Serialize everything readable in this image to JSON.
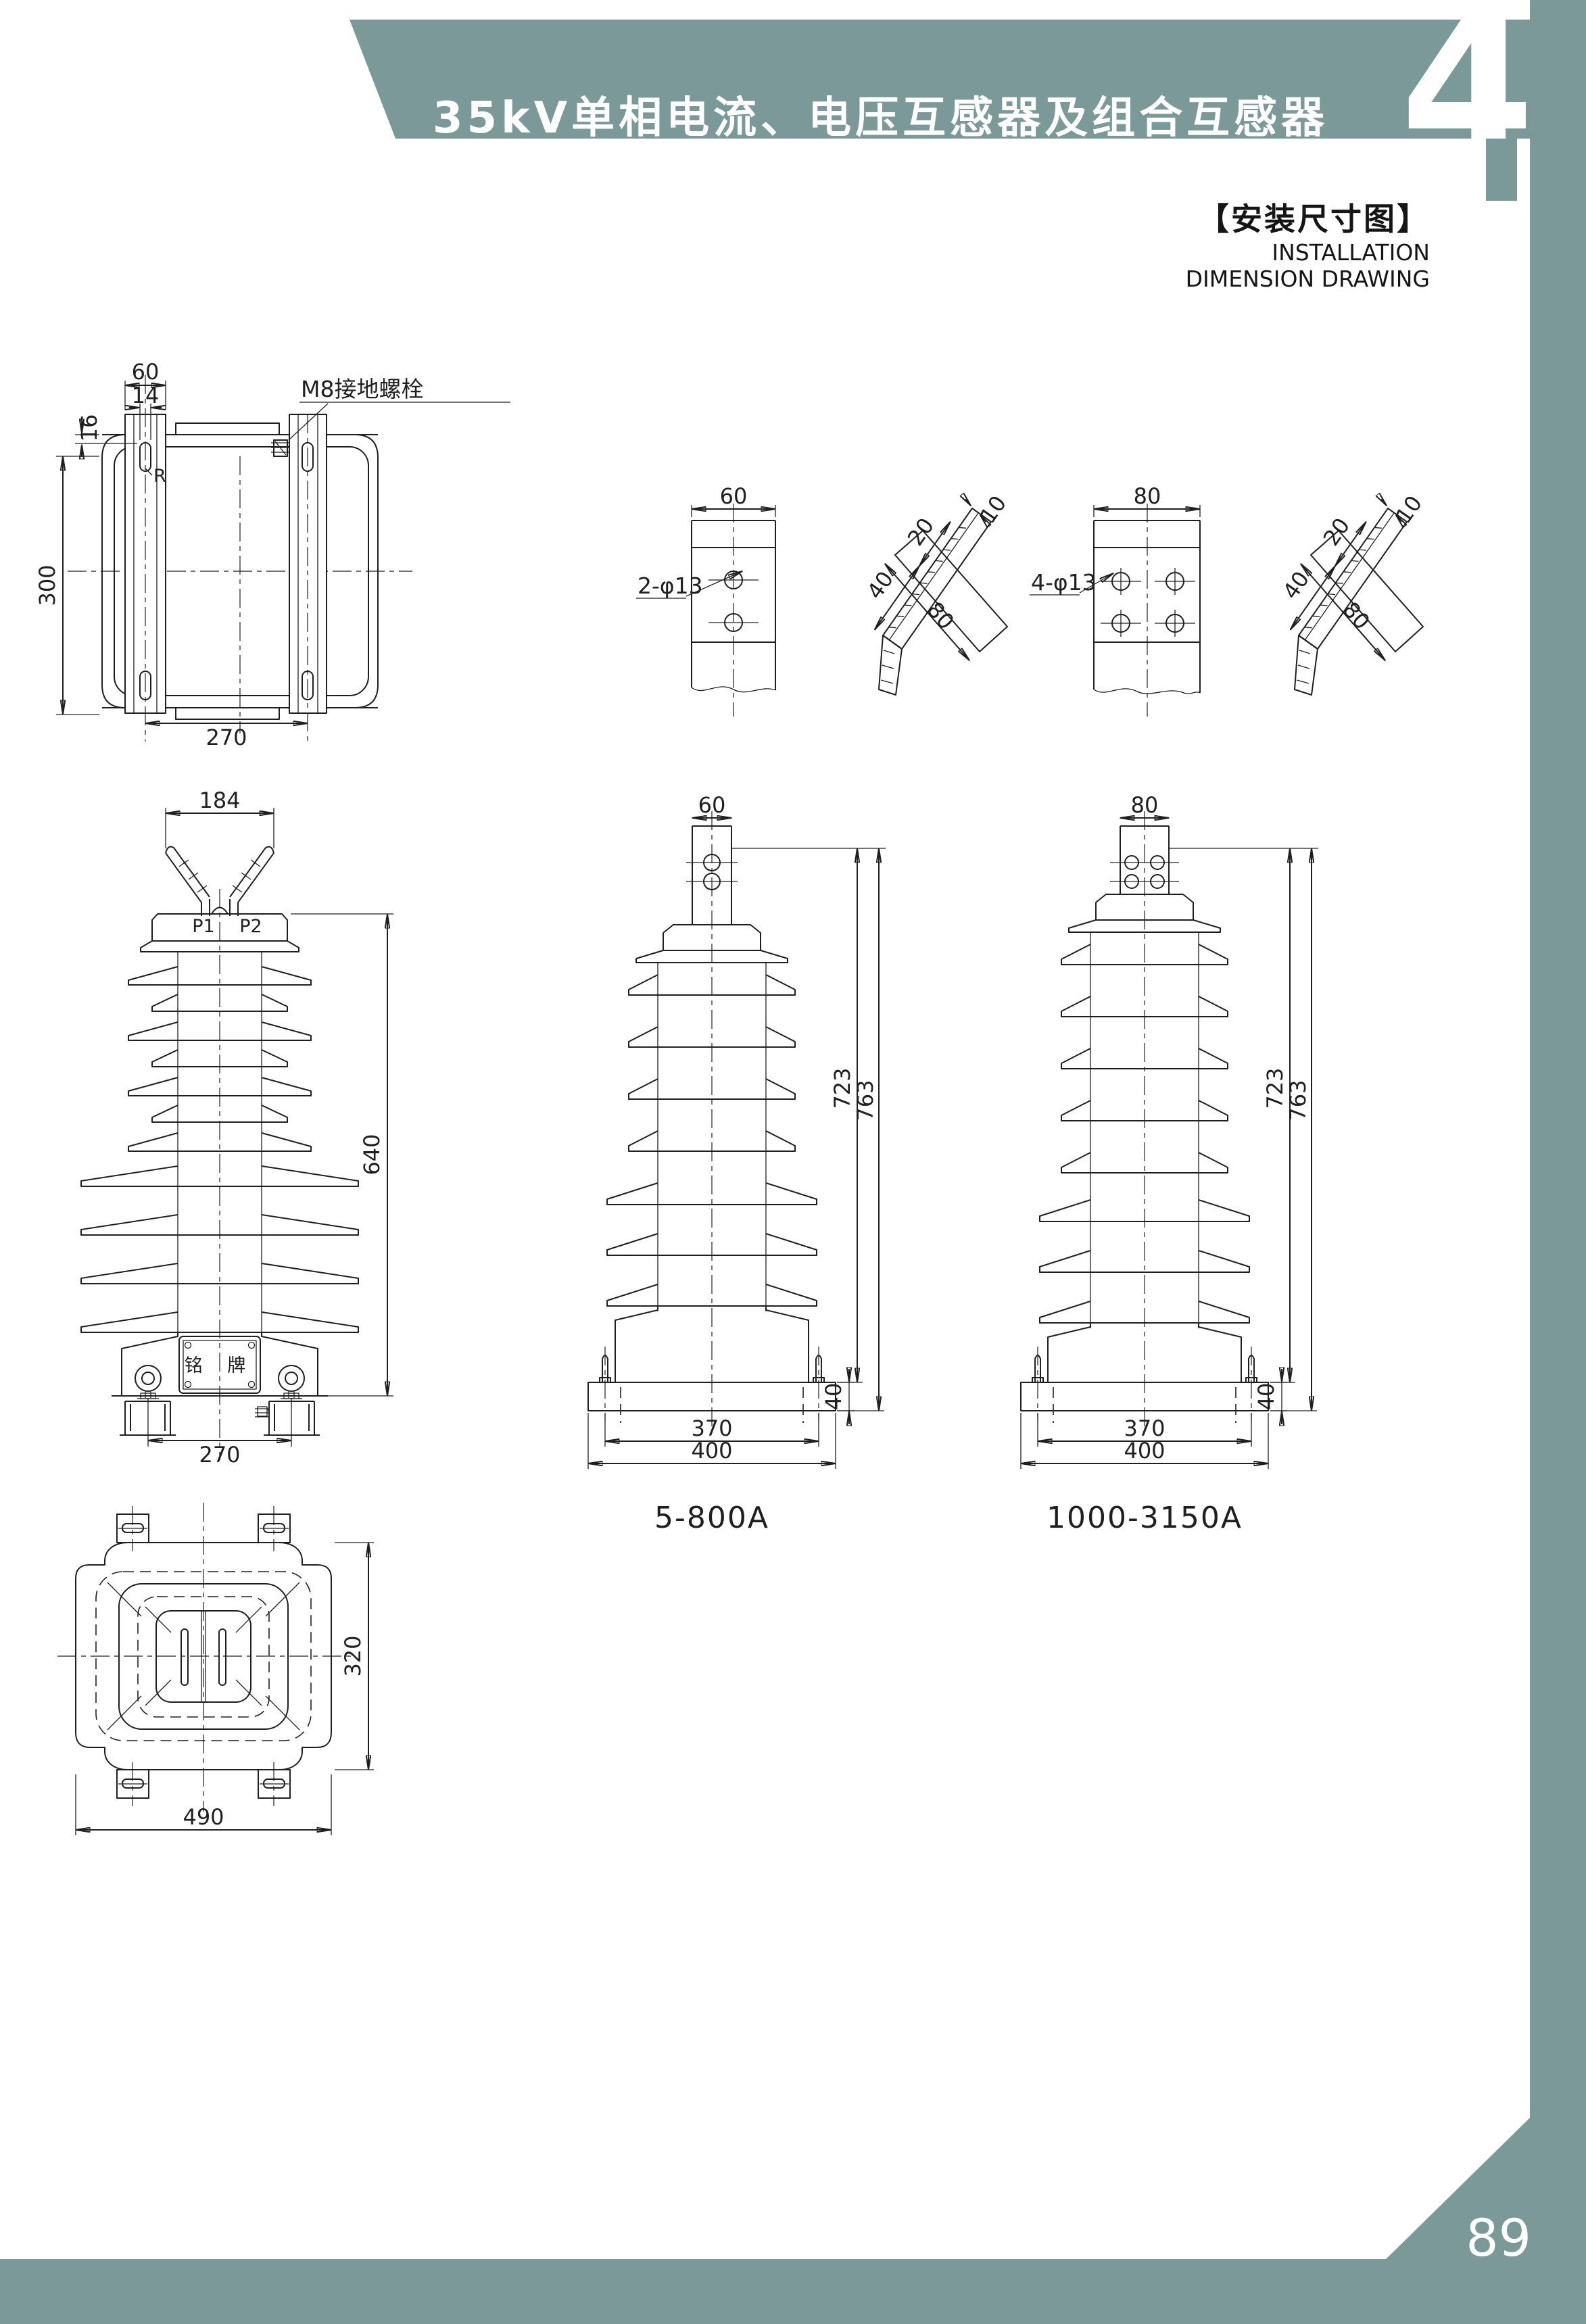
{
  "page": {
    "header_title": "35kV单相电流、电压互感器及组合互感器",
    "chapter_number": "4",
    "section_title_zh": "【安装尺寸图】",
    "section_title_en_line1": "INSTALLATION",
    "section_title_en_line2": "DIMENSION DRAWING",
    "page_number": "89",
    "accent_color": "#7a9998",
    "line_color": "#1f1f1f"
  },
  "base_front_view": {
    "dim_top_width": "60",
    "dim_slot_width": "14",
    "dim_slot_offset": "16",
    "dim_height": "300",
    "dim_bottom_width": "270",
    "ground_bolt_label": "M8接地螺栓",
    "radius_label": "R"
  },
  "terminal_plate_2hole": {
    "dim_width": "60",
    "holes_label": "2-φ13"
  },
  "terminal_side_view_small": {
    "dim_40": "40",
    "dim_20": "20",
    "dim_10": "10",
    "dim_80": "80"
  },
  "terminal_plate_4hole": {
    "dim_width": "80",
    "holes_label": "4-φ13"
  },
  "terminal_side_view_large": {
    "dim_40": "40",
    "dim_20": "20",
    "dim_10": "10",
    "dim_80": "80"
  },
  "transformer_front_view": {
    "dim_top_width": "184",
    "terminal_p1": "P1",
    "terminal_p2": "P2",
    "dim_height": "640",
    "dim_bottom_width": "270",
    "nameplate_label": "铭 牌"
  },
  "transformer_5_800a": {
    "dim_terminal_width": "60",
    "dim_height_723": "723",
    "dim_height_763": "763",
    "dim_base_height": "40",
    "dim_hole_span": "370",
    "dim_base_width": "400",
    "range_label": "5-800A"
  },
  "transformer_1000_3150a": {
    "dim_terminal_width": "80",
    "dim_height_723": "723",
    "dim_height_763": "763",
    "dim_base_height": "40",
    "dim_hole_span": "370",
    "dim_base_width": "400",
    "range_label": "1000-3150A"
  },
  "top_view": {
    "dim_height": "320",
    "dim_width": "490"
  }
}
